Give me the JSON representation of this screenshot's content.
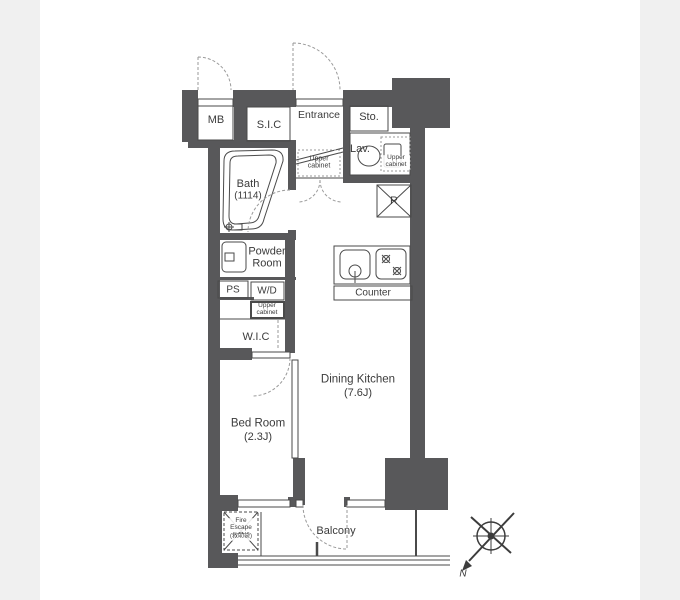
{
  "colors": {
    "wall": "#58585a",
    "background": "#f0f0f0",
    "paper": "#ffffff",
    "line": "#4a4a4a",
    "dash": "#9a9a9a",
    "text": "#3b3b3b"
  },
  "rooms": {
    "mb": "MB",
    "sic": "S.I.C",
    "entrance": "Entrance",
    "storage": "Sto.",
    "lavatory": "Lav.",
    "bath": {
      "name": "Bath",
      "size": "(1114)"
    },
    "powder_room": "Powder Room",
    "ps": "PS",
    "wd": "W/D",
    "wic": "W.I.C",
    "bedroom": {
      "name": "Bed Room",
      "size": "(2.3J)"
    },
    "dining_kitchen": {
      "name": "Dining Kitchen",
      "size": "(7.6J)"
    },
    "balcony": "Balcony",
    "refrigerator": "R",
    "counter": "Counter"
  },
  "cabinets": {
    "corridor_upper": "Upper cabinet",
    "lav_upper": "Upper cabinet",
    "laundry_upper": "Upper cabinet"
  },
  "fire_escape": {
    "label": "Fire Escape",
    "sublabel": "(救助袋)"
  },
  "compass": {
    "north": "N"
  }
}
